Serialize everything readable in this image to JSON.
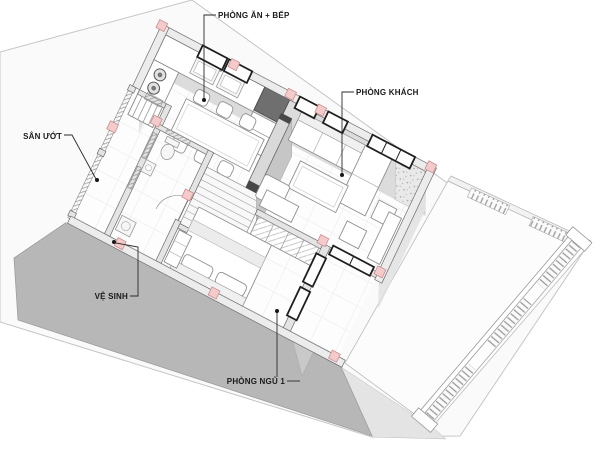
{
  "view": {
    "type": "3d-axonometric-floor-plan",
    "background": "#ffffff",
    "floor_shown": "ground floor cutaway with furniture"
  },
  "labels": {
    "dining_kitchen": "PHÒNG ĂN + BẾP",
    "living_room": "PHÒNG KHÁCH",
    "wet_yard": "SÂN ƯỚT",
    "toilet": "VỆ SINH",
    "bedroom_1": "PHÒNG NGỦ 1"
  },
  "colors": {
    "ground_plane": "#fafafa",
    "terrace": "#fcfcfc",
    "front_wall_face": "#b7b7b7",
    "wall_top": "#ececec",
    "wall_inner_face": "#d6d6d6",
    "section_marker_pink": "#f5caca",
    "window_frame": "#1f1f1f",
    "floor": "#fdfdfd",
    "floor_grid": "#e8e8e8",
    "leader_line": "#2b2b2b"
  }
}
